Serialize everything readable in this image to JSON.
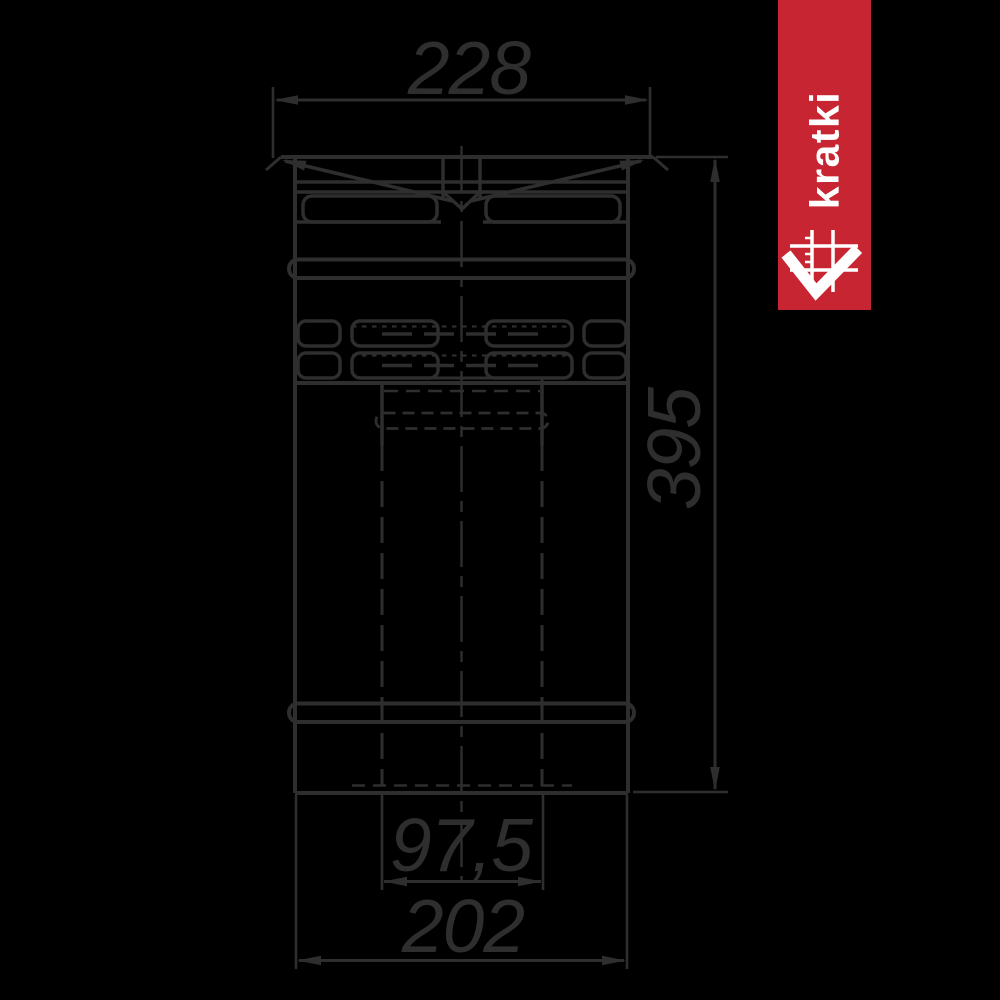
{
  "colors": {
    "background": "#000000",
    "line": "#2e2e2e"
  },
  "badge": {
    "brand_text": "kratki",
    "bg_color": "#c72531",
    "fg_color": "#ffffff"
  },
  "dims": {
    "top": {
      "label": "228"
    },
    "right": {
      "label": "395"
    },
    "bottom_inner": {
      "label": "97,5"
    },
    "bottom_outer": {
      "label": "202"
    }
  }
}
